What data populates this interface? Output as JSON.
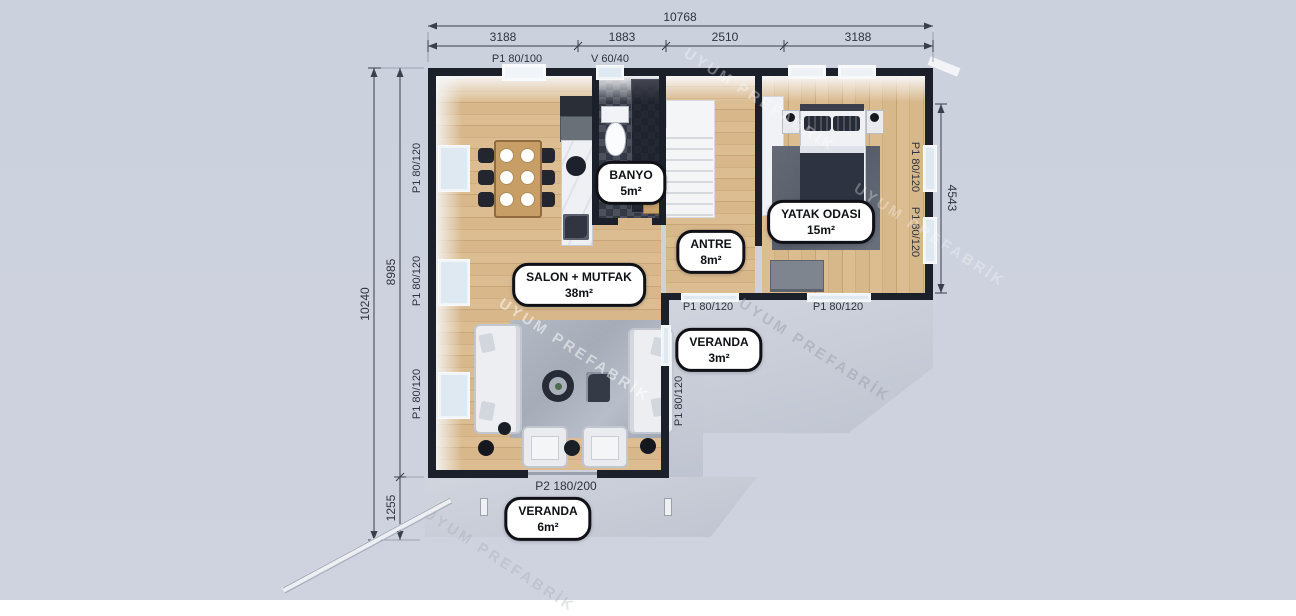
{
  "watermark": "UYUM PREFABRİK",
  "rooms": [
    {
      "name": "BANYO",
      "area": "5m²"
    },
    {
      "name": "YATAK ODASI",
      "area": "15m²"
    },
    {
      "name": "ANTRE",
      "area": "8m²"
    },
    {
      "name": "SALON + MUTFAK",
      "area": "38m²"
    },
    {
      "name": "VERANDA",
      "area": "3m²"
    },
    {
      "name": "VERANDA",
      "area": "6m²"
    }
  ],
  "dimensions": {
    "top": {
      "total": "10768",
      "segments": [
        "3188",
        "1883",
        "2510",
        "3188"
      ]
    },
    "left": {
      "total": "10240",
      "upper": "8985",
      "lower": "1255"
    },
    "right": {
      "height": "4543"
    }
  },
  "openings": {
    "entry_door": "P1 80/100",
    "bath_window": "V 60/40",
    "left_wall_windows": [
      "P1 80/120",
      "P1 80/120",
      "P1 80/120"
    ],
    "right_wall_windows": [
      "P1 80/120",
      "P1 80/120"
    ],
    "veranda_wall_windows": [
      "P1 80/120",
      "P1 80/120"
    ],
    "salon_side_window": "P1 80/120",
    "veranda_door": "P2 180/200"
  },
  "colors": {
    "background": "#ccd1de",
    "wall": "#1b202b",
    "wood_floor": "#d5b386",
    "concrete": "#c9cdd7",
    "badge_bg": "#ffffff",
    "badge_border": "#0f1116",
    "dimension_text": "#2f333d"
  }
}
